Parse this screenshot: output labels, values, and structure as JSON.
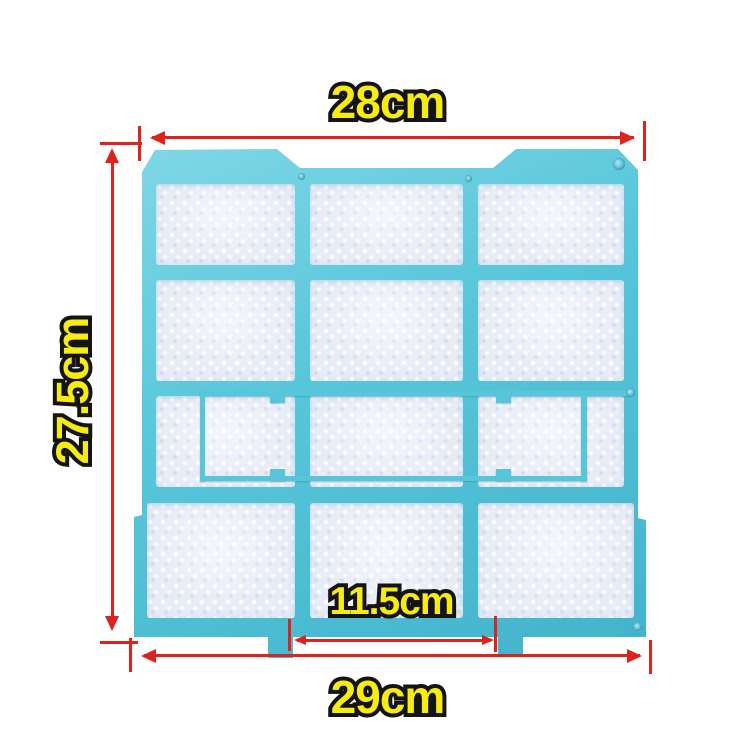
{
  "subject": "air-conditioner-filter-dimension-diagram",
  "dimensions": {
    "top": "28cm",
    "left": "27.5cm",
    "inner": "11.5cm",
    "bottom": "29cm"
  },
  "colors": {
    "frame_teal": "#58c6da",
    "frame_teal_light": "#7fd7e5",
    "frame_teal_dark": "#41b3cb",
    "mesh": "#e8ecf7",
    "dimension_red": "#df221b",
    "label_yellow": "#f6ec11",
    "label_outline": "#141414",
    "background": "#ffffff"
  }
}
